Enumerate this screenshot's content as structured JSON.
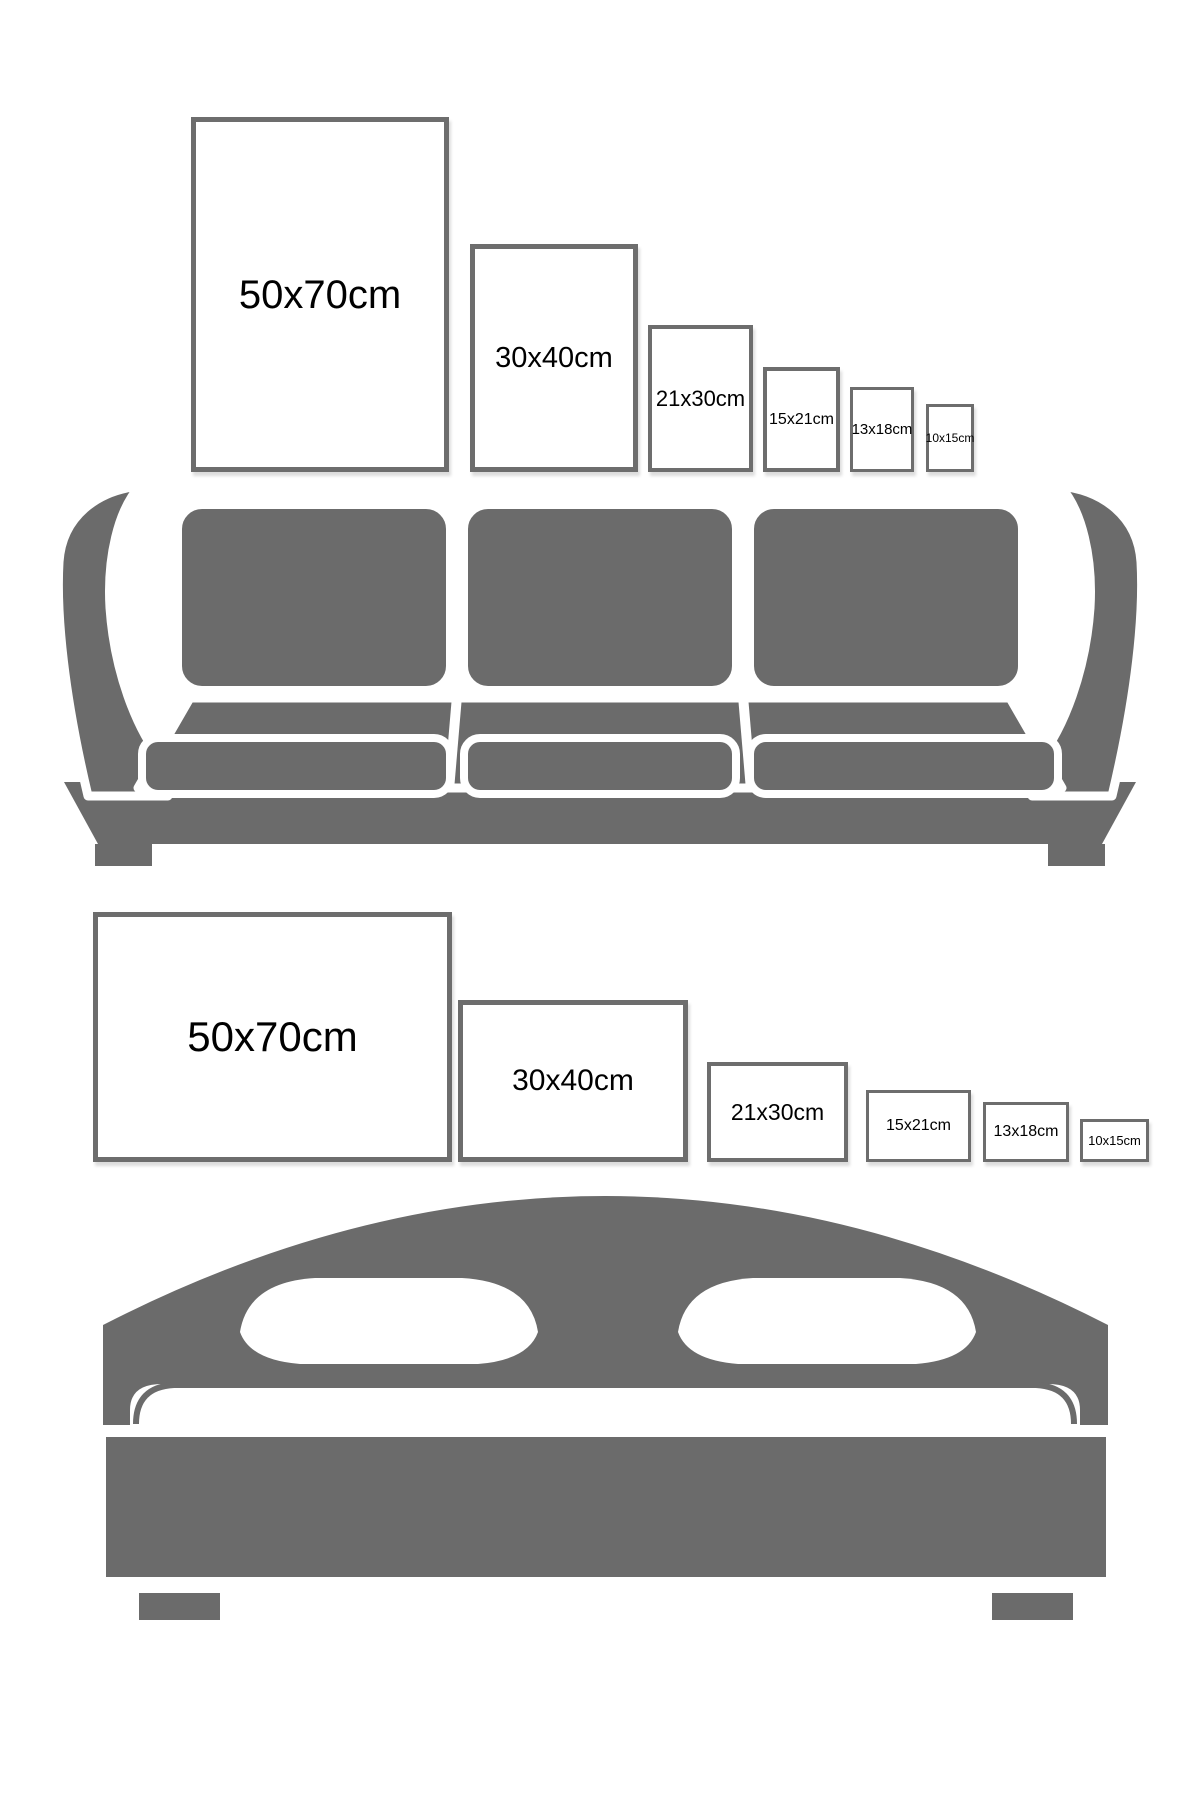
{
  "infographic": {
    "type": "poster-frame size comparison guide",
    "colors": {
      "furniture_gray": "#6b6b6b",
      "frame_border_gray": "#6d6d6d",
      "label_black": "#000000",
      "background_white": "#ffffff"
    },
    "walls": [
      {
        "id": "sofa-wall",
        "furniture": "sofa",
        "frame_orientation": "portrait",
        "frames": [
          {
            "label": "50x70cm"
          },
          {
            "label": "30x40cm"
          },
          {
            "label": "21x30cm"
          },
          {
            "label": "15x21cm"
          },
          {
            "label": "13x18cm"
          },
          {
            "label": "10x15cm"
          }
        ]
      },
      {
        "id": "bed-wall",
        "furniture": "bed",
        "frame_orientation": "landscape",
        "frames": [
          {
            "label": "50x70cm"
          },
          {
            "label": "30x40cm"
          },
          {
            "label": "21x30cm"
          },
          {
            "label": "15x21cm"
          },
          {
            "label": "13x18cm"
          },
          {
            "label": "10x15cm"
          }
        ]
      }
    ]
  }
}
